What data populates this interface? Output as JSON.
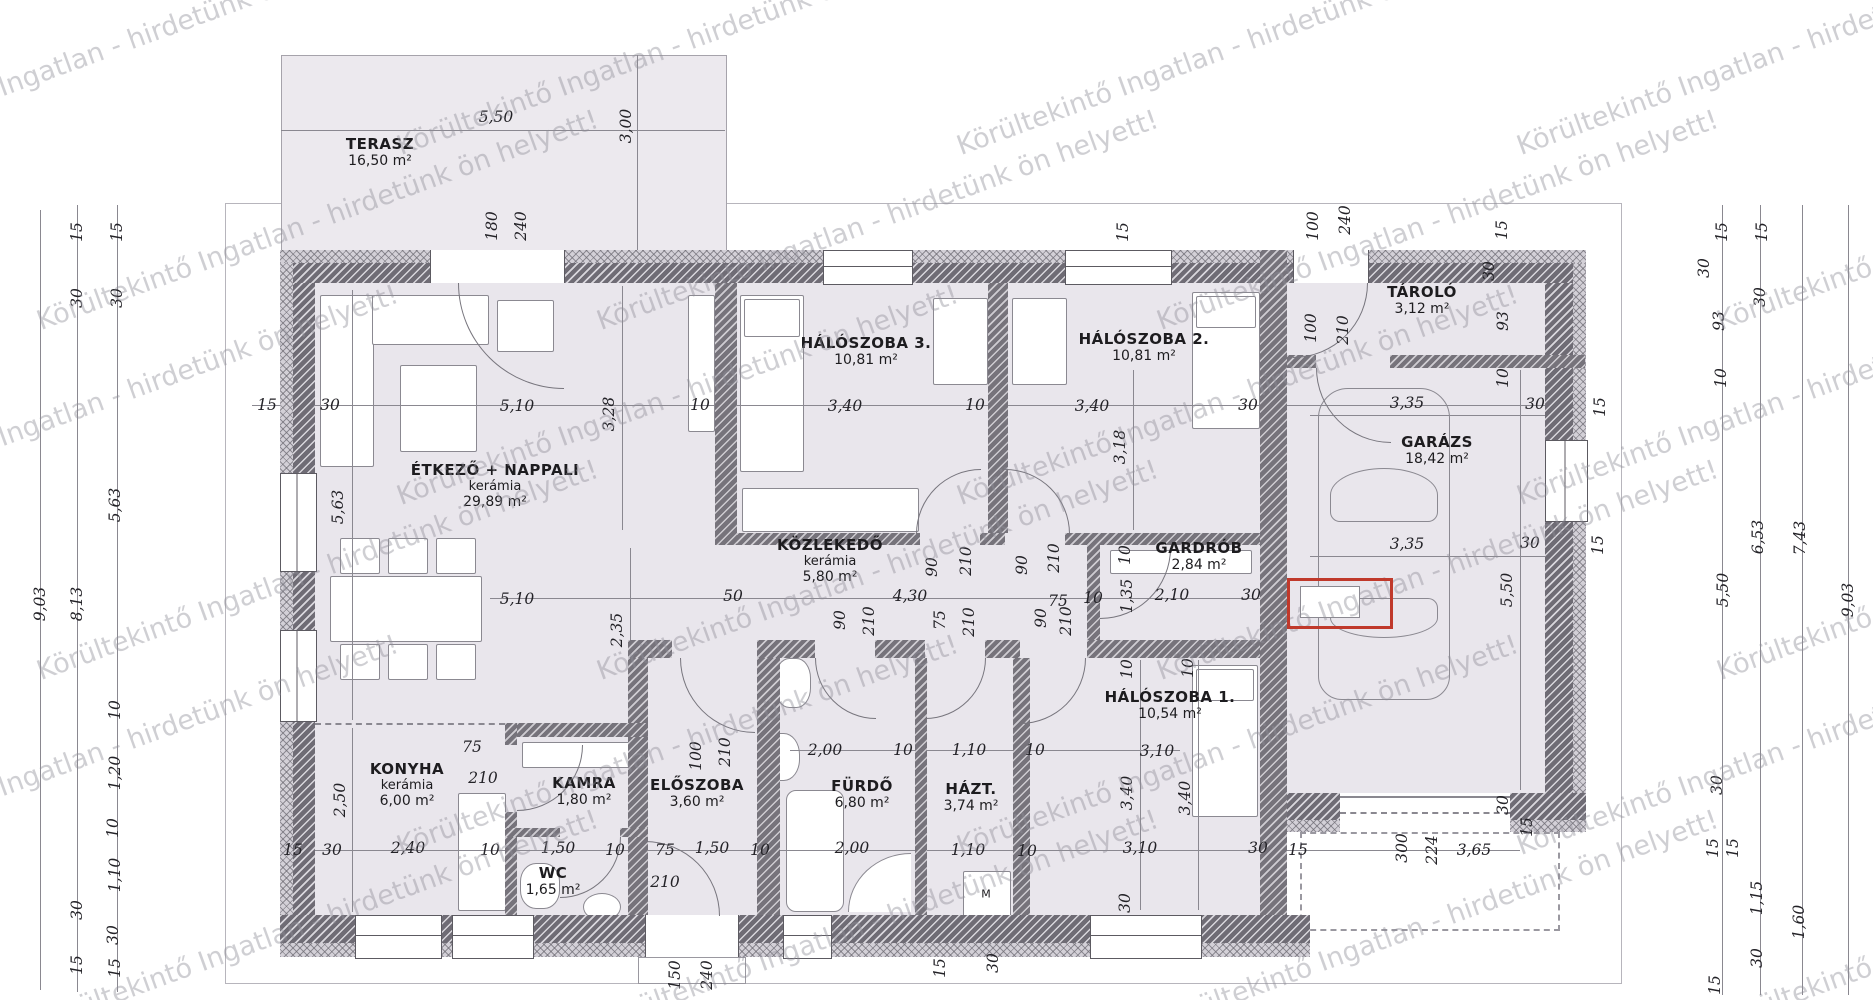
{
  "watermark": {
    "text": "Körültekintő Ingatlan - hirdetünk ön helyett!",
    "color": "#8f8e98"
  },
  "colors": {
    "room_fill": "#e9e6ec",
    "wall": "#6f6c75",
    "annotation_red": "#c0392b",
    "dim_text": "#232227"
  },
  "rooms": [
    {
      "name": "TERASZ",
      "area": "16,50 m²",
      "x": 380,
      "y": 145
    },
    {
      "name": "ÉTKEZŐ + NAPPALI",
      "mat": "kerámia",
      "area": "29,89 m²",
      "x": 495,
      "y": 471
    },
    {
      "name": "HÁLÓSZOBA 3.",
      "area": "10,81 m²",
      "x": 866,
      "y": 344
    },
    {
      "name": "HÁLÓSZOBA 2.",
      "area": "10,81 m²",
      "x": 1144,
      "y": 340
    },
    {
      "name": "TÁROLÓ",
      "area": "3,12 m²",
      "x": 1422,
      "y": 293
    },
    {
      "name": "GARÁZS",
      "area": "18,42 m²",
      "x": 1437,
      "y": 443
    },
    {
      "name": "KÖZLEKEDŐ",
      "mat": "kerámia",
      "area": "5,80 m²",
      "x": 830,
      "y": 546
    },
    {
      "name": "GARDRÓB",
      "area": "2,84 m²",
      "x": 1199,
      "y": 549
    },
    {
      "name": "HÁLÓSZOBA 1.",
      "area": "10,54 m²",
      "x": 1170,
      "y": 698
    },
    {
      "name": "KONYHA",
      "mat": "kerámia",
      "area": "6,00 m²",
      "x": 407,
      "y": 770
    },
    {
      "name": "KAMRA",
      "area": "1,80 m²",
      "x": 584,
      "y": 784
    },
    {
      "name": "ELŐSZOBA",
      "area": "3,60 m²",
      "x": 697,
      "y": 786
    },
    {
      "name": "FÜRDŐ",
      "area": "6,80 m²",
      "x": 862,
      "y": 787
    },
    {
      "name": "HÁZT.",
      "area": "3,74 m²",
      "x": 971,
      "y": 790
    },
    {
      "name": "WC",
      "area": "1,65 m²",
      "x": 553,
      "y": 874
    }
  ],
  "fixtures": {
    "washing_machine": "M"
  },
  "dims": [
    {
      "t": "5,50",
      "x": 496,
      "y": 117
    },
    {
      "t": "3,00",
      "x": 626,
      "y": 126,
      "r": 1
    },
    {
      "t": "180",
      "x": 492,
      "y": 226,
      "r": 1
    },
    {
      "t": "240",
      "x": 521,
      "y": 226,
      "r": 1
    },
    {
      "t": "100",
      "x": 1313,
      "y": 226,
      "r": 1
    },
    {
      "t": "240",
      "x": 1345,
      "y": 220,
      "r": 1
    },
    {
      "t": "15",
      "x": 1123,
      "y": 232,
      "r": 1
    },
    {
      "t": "15",
      "x": 1502,
      "y": 230,
      "r": 1
    },
    {
      "t": "30",
      "x": 1489,
      "y": 271,
      "r": 1
    },
    {
      "t": "93",
      "x": 1503,
      "y": 321,
      "r": 1
    },
    {
      "t": "10",
      "x": 1503,
      "y": 378,
      "r": 1
    },
    {
      "t": "15",
      "x": 1722,
      "y": 232,
      "r": 1
    },
    {
      "t": "30",
      "x": 1704,
      "y": 268,
      "r": 1
    },
    {
      "t": "93",
      "x": 1719,
      "y": 321,
      "r": 1
    },
    {
      "t": "10",
      "x": 1721,
      "y": 378,
      "r": 1
    },
    {
      "t": "15",
      "x": 1762,
      "y": 232,
      "r": 1
    },
    {
      "t": "30",
      "x": 1760,
      "y": 297,
      "r": 1
    },
    {
      "t": "15",
      "x": 267,
      "y": 405
    },
    {
      "t": "30",
      "x": 330,
      "y": 405
    },
    {
      "t": "5,10",
      "x": 517,
      "y": 406
    },
    {
      "t": "3,28",
      "x": 609,
      "y": 414,
      "r": 1
    },
    {
      "t": "10",
      "x": 700,
      "y": 405
    },
    {
      "t": "3,40",
      "x": 845,
      "y": 406
    },
    {
      "t": "10",
      "x": 975,
      "y": 405
    },
    {
      "t": "3,40",
      "x": 1092,
      "y": 406
    },
    {
      "t": "30",
      "x": 1248,
      "y": 405
    },
    {
      "t": "3,18",
      "x": 1120,
      "y": 447,
      "r": 1
    },
    {
      "t": "3,35",
      "x": 1407,
      "y": 403
    },
    {
      "t": "30",
      "x": 1535,
      "y": 404
    },
    {
      "t": "15",
      "x": 1600,
      "y": 407,
      "r": 1
    },
    {
      "t": "9,03",
      "x": 40,
      "y": 604,
      "r": 1
    },
    {
      "t": "8,13",
      "x": 77,
      "y": 604,
      "r": 1
    },
    {
      "t": "15",
      "x": 77,
      "y": 232,
      "r": 1
    },
    {
      "t": "30",
      "x": 77,
      "y": 298,
      "r": 1
    },
    {
      "t": "15",
      "x": 117,
      "y": 232,
      "r": 1
    },
    {
      "t": "30",
      "x": 117,
      "y": 298,
      "r": 1
    },
    {
      "t": "5,63",
      "x": 115,
      "y": 505,
      "r": 1
    },
    {
      "t": "10",
      "x": 115,
      "y": 710,
      "r": 1
    },
    {
      "t": "1,20",
      "x": 115,
      "y": 773,
      "r": 1
    },
    {
      "t": "10",
      "x": 113,
      "y": 828,
      "r": 1
    },
    {
      "t": "1,10",
      "x": 115,
      "y": 875,
      "r": 1
    },
    {
      "t": "30",
      "x": 77,
      "y": 910,
      "r": 1
    },
    {
      "t": "30",
      "x": 113,
      "y": 935,
      "r": 1
    },
    {
      "t": "15",
      "x": 77,
      "y": 965,
      "r": 1
    },
    {
      "t": "15",
      "x": 115,
      "y": 968,
      "r": 1
    },
    {
      "t": "5,63",
      "x": 338,
      "y": 507,
      "r": 1
    },
    {
      "t": "2,50",
      "x": 340,
      "y": 800,
      "r": 1
    },
    {
      "t": "2,35",
      "x": 617,
      "y": 630,
      "r": 1
    },
    {
      "t": "5,50",
      "x": 1507,
      "y": 590,
      "r": 1
    },
    {
      "t": "5,10",
      "x": 517,
      "y": 599
    },
    {
      "t": "50",
      "x": 733,
      "y": 596
    },
    {
      "t": "4,30",
      "x": 910,
      "y": 596
    },
    {
      "t": "75",
      "x": 1058,
      "y": 601
    },
    {
      "t": "10",
      "x": 1093,
      "y": 598
    },
    {
      "t": "1,35",
      "x": 1127,
      "y": 596,
      "r": 1
    },
    {
      "t": "2,10",
      "x": 1172,
      "y": 595
    },
    {
      "t": "30",
      "x": 1251,
      "y": 595
    },
    {
      "t": "3,35",
      "x": 1407,
      "y": 544
    },
    {
      "t": "30",
      "x": 1530,
      "y": 543
    },
    {
      "t": "15",
      "x": 1598,
      "y": 545,
      "r": 1
    },
    {
      "t": "90",
      "x": 932,
      "y": 567,
      "r": 1
    },
    {
      "t": "210",
      "x": 966,
      "y": 561,
      "r": 1
    },
    {
      "t": "90",
      "x": 1022,
      "y": 565,
      "r": 1
    },
    {
      "t": "210",
      "x": 1054,
      "y": 558,
      "r": 1
    },
    {
      "t": "10",
      "x": 1125,
      "y": 555,
      "r": 1
    },
    {
      "t": "90",
      "x": 840,
      "y": 620,
      "r": 1
    },
    {
      "t": "210",
      "x": 869,
      "y": 621,
      "r": 1
    },
    {
      "t": "75",
      "x": 940,
      "y": 620,
      "r": 1
    },
    {
      "t": "210",
      "x": 969,
      "y": 622,
      "r": 1
    },
    {
      "t": "90",
      "x": 1041,
      "y": 618,
      "r": 1
    },
    {
      "t": "210",
      "x": 1066,
      "y": 621,
      "r": 1
    },
    {
      "t": "10",
      "x": 1127,
      "y": 669,
      "r": 1
    },
    {
      "t": "10",
      "x": 1188,
      "y": 668,
      "r": 1
    },
    {
      "t": "100",
      "x": 1311,
      "y": 328,
      "r": 1
    },
    {
      "t": "210",
      "x": 1343,
      "y": 330,
      "r": 1
    },
    {
      "t": "2,00",
      "x": 825,
      "y": 750
    },
    {
      "t": "10",
      "x": 903,
      "y": 750
    },
    {
      "t": "1,10",
      "x": 969,
      "y": 750
    },
    {
      "t": "10",
      "x": 1035,
      "y": 750
    },
    {
      "t": "3,10",
      "x": 1157,
      "y": 751
    },
    {
      "t": "75",
      "x": 472,
      "y": 747
    },
    {
      "t": "210",
      "x": 483,
      "y": 778
    },
    {
      "t": "100",
      "x": 696,
      "y": 756,
      "r": 1
    },
    {
      "t": "210",
      "x": 725,
      "y": 752,
      "r": 1
    },
    {
      "t": "3,40",
      "x": 1127,
      "y": 793,
      "r": 1
    },
    {
      "t": "3,40",
      "x": 1185,
      "y": 798,
      "r": 1
    },
    {
      "t": "15",
      "x": 293,
      "y": 850
    },
    {
      "t": "30",
      "x": 332,
      "y": 850
    },
    {
      "t": "2,40",
      "x": 408,
      "y": 848
    },
    {
      "t": "10",
      "x": 490,
      "y": 850
    },
    {
      "t": "1,50",
      "x": 558,
      "y": 848
    },
    {
      "t": "10",
      "x": 615,
      "y": 850
    },
    {
      "t": "75",
      "x": 665,
      "y": 850
    },
    {
      "t": "1,50",
      "x": 712,
      "y": 848
    },
    {
      "t": "10",
      "x": 760,
      "y": 850
    },
    {
      "t": "2,00",
      "x": 852,
      "y": 848
    },
    {
      "t": "1,10",
      "x": 968,
      "y": 850
    },
    {
      "t": "10",
      "x": 1027,
      "y": 851
    },
    {
      "t": "3,10",
      "x": 1140,
      "y": 848
    },
    {
      "t": "30",
      "x": 1258,
      "y": 848
    },
    {
      "t": "15",
      "x": 1298,
      "y": 850
    },
    {
      "t": "300",
      "x": 1402,
      "y": 848,
      "r": 1
    },
    {
      "t": "224",
      "x": 1432,
      "y": 850,
      "r": 1
    },
    {
      "t": "3,65",
      "x": 1474,
      "y": 850
    },
    {
      "t": "210",
      "x": 665,
      "y": 882
    },
    {
      "t": "150",
      "x": 675,
      "y": 975,
      "r": 1
    },
    {
      "t": "240",
      "x": 707,
      "y": 975,
      "r": 1
    },
    {
      "t": "30",
      "x": 1125,
      "y": 903,
      "r": 1
    },
    {
      "t": "15",
      "x": 940,
      "y": 968,
      "r": 1
    },
    {
      "t": "30",
      "x": 993,
      "y": 963,
      "r": 1
    },
    {
      "t": "30",
      "x": 1503,
      "y": 805,
      "r": 1
    },
    {
      "t": "15",
      "x": 1527,
      "y": 827,
      "r": 1
    },
    {
      "t": "30",
      "x": 1717,
      "y": 785,
      "r": 1
    },
    {
      "t": "15",
      "x": 1713,
      "y": 848,
      "r": 1
    },
    {
      "t": "15",
      "x": 1733,
      "y": 848,
      "r": 1
    },
    {
      "t": "1,15",
      "x": 1757,
      "y": 898,
      "r": 1
    },
    {
      "t": "1,60",
      "x": 1799,
      "y": 922,
      "r": 1
    },
    {
      "t": "30",
      "x": 1757,
      "y": 958,
      "r": 1
    },
    {
      "t": "15",
      "x": 1715,
      "y": 985,
      "r": 1
    },
    {
      "t": "5,50",
      "x": 1723,
      "y": 590,
      "r": 1
    },
    {
      "t": "6,53",
      "x": 1758,
      "y": 537,
      "r": 1
    },
    {
      "t": "7,43",
      "x": 1800,
      "y": 538,
      "r": 1
    },
    {
      "t": "9,03",
      "x": 1848,
      "y": 600,
      "r": 1
    }
  ]
}
